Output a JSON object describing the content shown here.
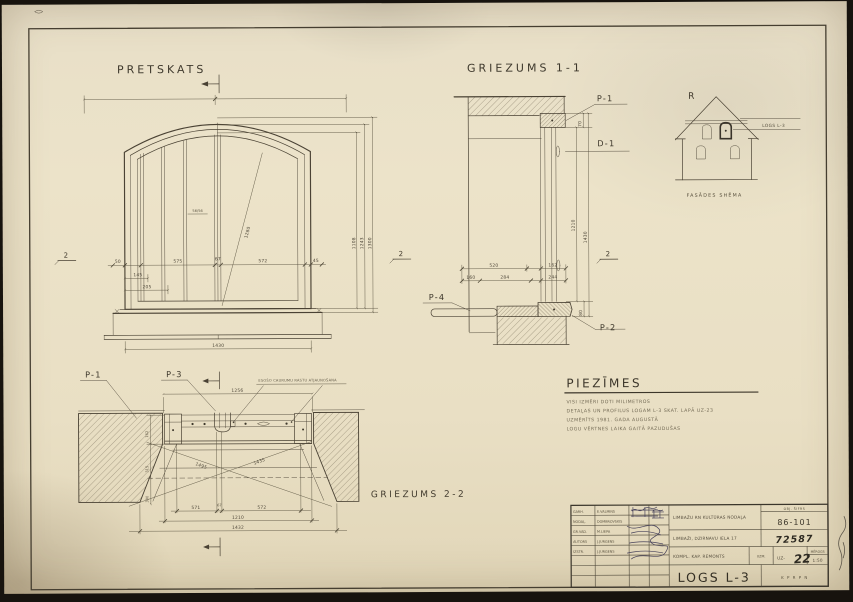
{
  "front": {
    "title": "PRETSKATS",
    "marker_left": "2",
    "marker_right": "2",
    "dims": {
      "w1": "50",
      "w2": "575",
      "w3": "67",
      "w4": "572",
      "w5": "45",
      "w6": "145",
      "w7": "205",
      "total": "1430",
      "h1": "1108",
      "h2": "1243",
      "h3": "1300",
      "radius": "1280",
      "glass": "56/56"
    }
  },
  "section1": {
    "title": "GRIEZUMS 1-1",
    "p1": "P-1",
    "d1": "D-1",
    "p4": "P-4",
    "p2": "P-2",
    "marker": "2",
    "dims": {
      "top": "70",
      "inner": "1210",
      "outer": "1430",
      "bottom": "80",
      "a": "520",
      "b": "162",
      "c": "160",
      "d": "284",
      "e": "244"
    }
  },
  "section2": {
    "title": "GRIEZUMS 2-2",
    "p1": "P-1",
    "p3": "P-3",
    "note": "ESOŠO CAURUMU RASTU ATJAUNOŠANA",
    "dims": {
      "top": "1256",
      "left1": "162",
      "left2": "315",
      "left3": "380",
      "diag1": "1495",
      "diag2": "1435",
      "b1": "571",
      "b2": "67",
      "b3": "572",
      "b4": "1210",
      "b5": "1432"
    }
  },
  "facade": {
    "r": "R",
    "label": "LOGS L-3",
    "caption": "FASĀDES SHĒMA"
  },
  "notes": {
    "title": "PIEZĪMES",
    "lines": [
      "VISI IZMĒRI DOTI MILIMETROS",
      "DETAĻAS UN PROFILUS LOGAM L-3 SKAT. LAPĀ UZ-23",
      "UZMĒRĪTS 1981. GADA AUGUSTĀ",
      "LOGU VĒRTNES LAIKA GAITĀ PAZUDUŠAS"
    ]
  },
  "titleblock": {
    "rows": [
      {
        "role": "GARH.",
        "name": "E.VALMINS"
      },
      {
        "role": "NODAĻ.",
        "name": "DOMBROVSKIS"
      },
      {
        "role": "GR.VAD.",
        "name": "M.LIEPA"
      },
      {
        "role": "AUTORS",
        "name": "J.JURGENS"
      },
      {
        "role": "IZSTR.",
        "name": "J.JURGENS"
      }
    ],
    "header": "OBJ. ŠIFRS",
    "code": "86-101",
    "archive": "72587",
    "client": "LIMBAŽU RN KULTŪRAS NODAĻA",
    "address": "LIMBAŽI, DZIRNAVU IELA 17",
    "work": "KOMPL. KAP. REMONTS",
    "uzm": "UZM.",
    "sheet_prefix": "UZ-",
    "sheet_no": "22",
    "scale_label": "MĒROGS",
    "scale": "1:50",
    "title": "LOGS L-3",
    "org": "K P R P N"
  }
}
